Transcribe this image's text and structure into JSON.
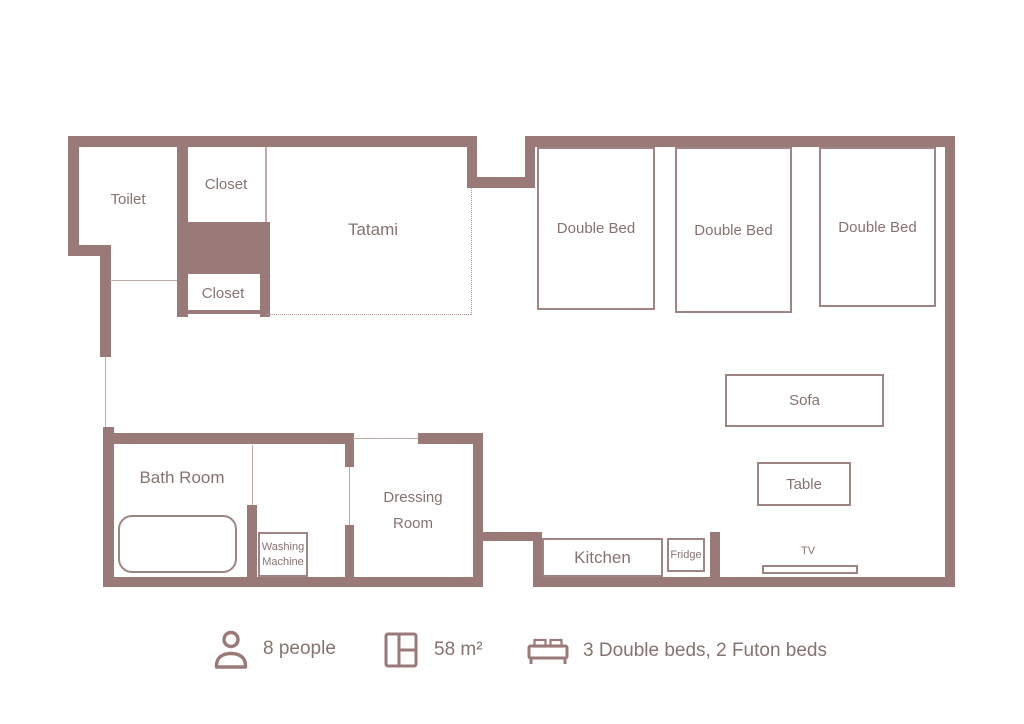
{
  "colors": {
    "wall": "#9a7a78",
    "furniture_border": "#9e8583",
    "text": "#867370",
    "door_line": "#c0aaa8",
    "dotted": "#b29795"
  },
  "rooms": {
    "toilet": "Toilet",
    "closet_top": "Closet",
    "closet_bottom": "Closet",
    "tatami": "Tatami",
    "bath_room": "Bath Room",
    "dressing_room": "Dressing Room",
    "kitchen": "Kitchen"
  },
  "furniture": {
    "double_bed_1": "Double Bed",
    "double_bed_2": "Double Bed",
    "double_bed_3": "Double Bed",
    "sofa": "Sofa",
    "table": "Table",
    "tv": "TV",
    "fridge": "Fridge",
    "washing_machine": "Washing Machine"
  },
  "legend": {
    "capacity": "8 people",
    "area": "58 m²",
    "beds": "3 Double beds, 2 Futon beds"
  }
}
